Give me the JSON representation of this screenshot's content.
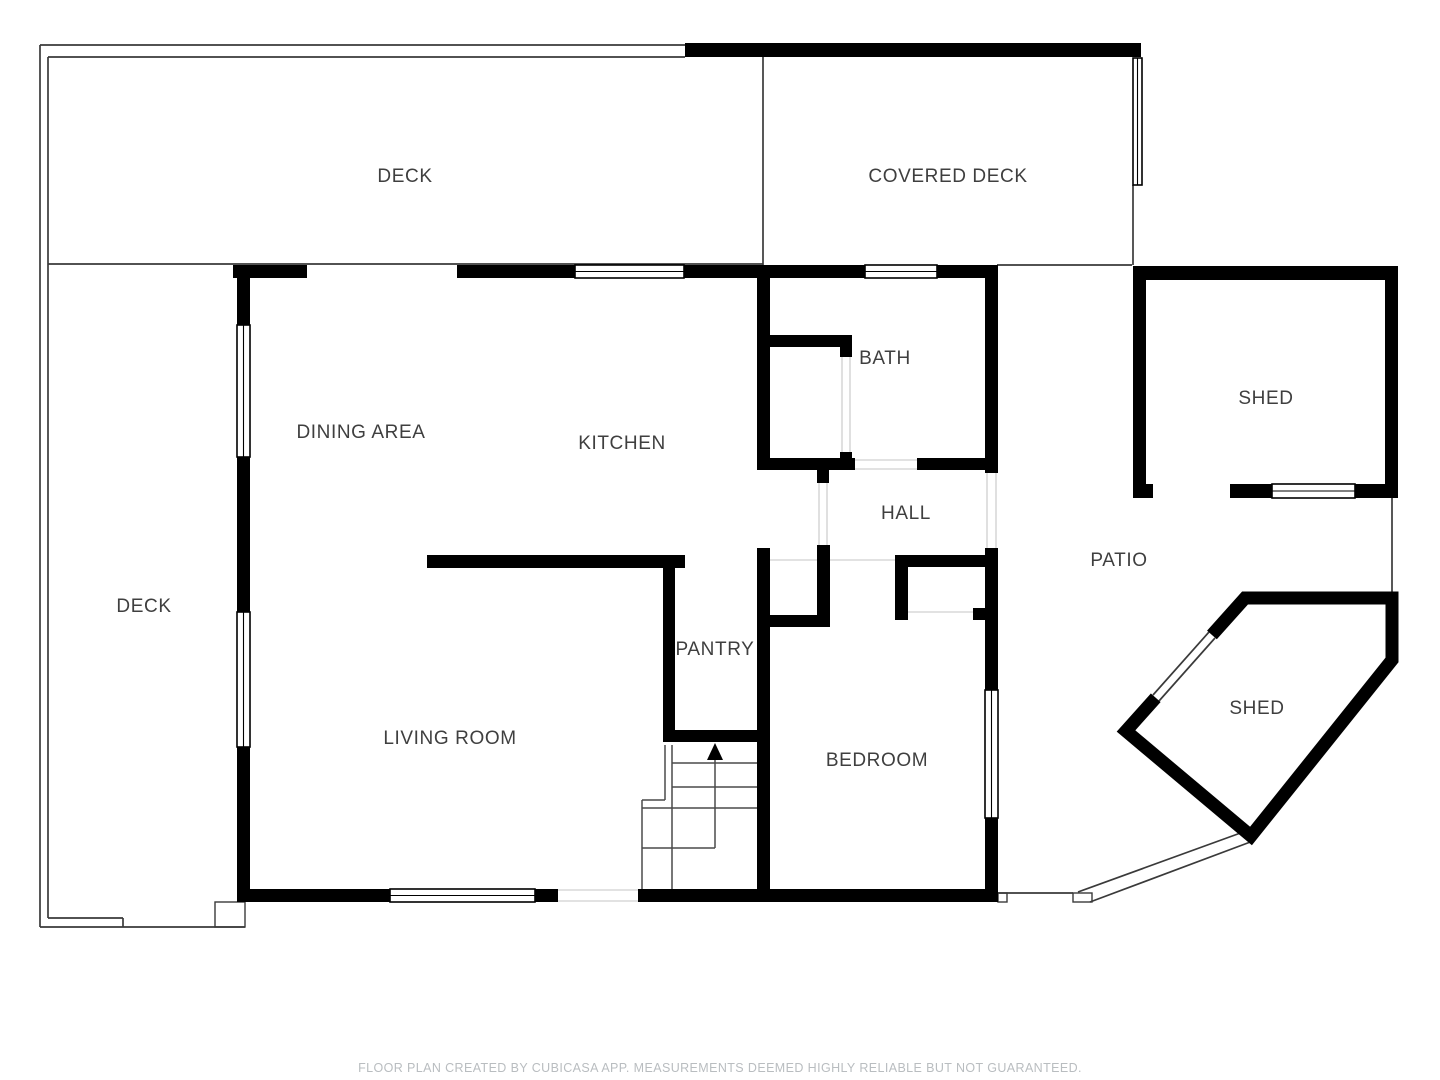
{
  "plan": {
    "colors": {
      "wall": "#000000",
      "outline": "#3a3a3a",
      "light_line": "#d8d8d8",
      "stair_line": "#4a4a4a",
      "label": "#3f3f3f",
      "footer": "#b9bdc0",
      "background": "#ffffff"
    }
  },
  "rooms": [
    {
      "slug": "deck-top",
      "label": "DECK",
      "x": 405,
      "y": 177
    },
    {
      "slug": "covered-deck",
      "label": "COVERED DECK",
      "x": 948,
      "y": 177
    },
    {
      "slug": "shed-top",
      "label": "SHED",
      "x": 1266,
      "y": 399
    },
    {
      "slug": "bath",
      "label": "BATH",
      "x": 885,
      "y": 359
    },
    {
      "slug": "dining-area",
      "label": "DINING AREA",
      "x": 361,
      "y": 433
    },
    {
      "slug": "kitchen",
      "label": "KITCHEN",
      "x": 622,
      "y": 444
    },
    {
      "slug": "hall",
      "label": "HALL",
      "x": 906,
      "y": 514
    },
    {
      "slug": "patio",
      "label": "PATIO",
      "x": 1119,
      "y": 561
    },
    {
      "slug": "deck-left",
      "label": "DECK",
      "x": 144,
      "y": 607
    },
    {
      "slug": "pantry",
      "label": "PANTRY",
      "x": 715,
      "y": 650
    },
    {
      "slug": "shed-bottom",
      "label": "SHED",
      "x": 1257,
      "y": 709
    },
    {
      "slug": "living-room",
      "label": "LIVING ROOM",
      "x": 450,
      "y": 739
    },
    {
      "slug": "bedroom",
      "label": "BEDROOM",
      "x": 877,
      "y": 761
    }
  ],
  "footer": {
    "text": "FLOOR PLAN CREATED BY CUBICASA APP. MEASUREMENTS DEEMED HIGHLY RELIABLE BUT NOT GUARANTEED."
  }
}
